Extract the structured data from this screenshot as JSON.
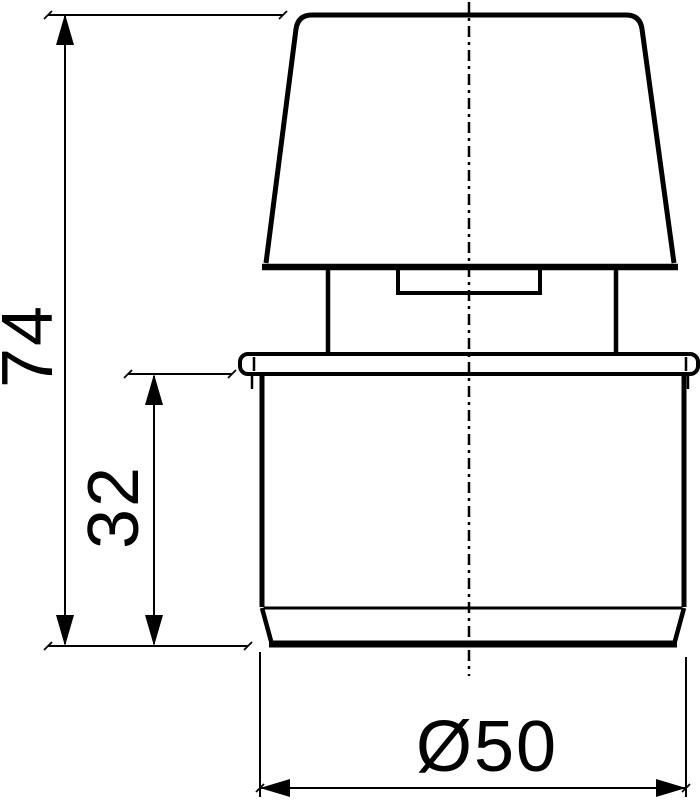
{
  "drawing": {
    "background_color": "#ffffff",
    "line_color": "#000000",
    "labels": {
      "overall_height": "74",
      "socket_height": "32",
      "diameter": "Ø50"
    }
  }
}
